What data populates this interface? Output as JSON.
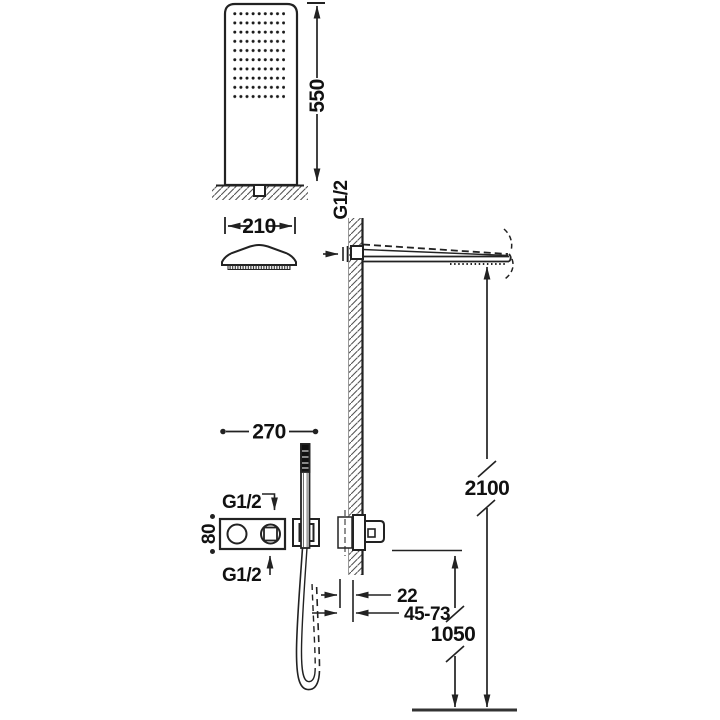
{
  "diagram": {
    "colors": {
      "line": "#222222",
      "text": "#111111",
      "background": "#ffffff"
    },
    "labels": {
      "column_height": "550",
      "head_width": "210",
      "arm_thread": "G1/2",
      "mixer_width": "270",
      "mixer_inlet_top": "G1/2",
      "mixer_height": "80",
      "mixer_inlet_bottom": "G1/2",
      "overall_height": "2100",
      "finish_gap": "22",
      "recess_depth": "45-73",
      "outlet_height": "1050"
    }
  }
}
